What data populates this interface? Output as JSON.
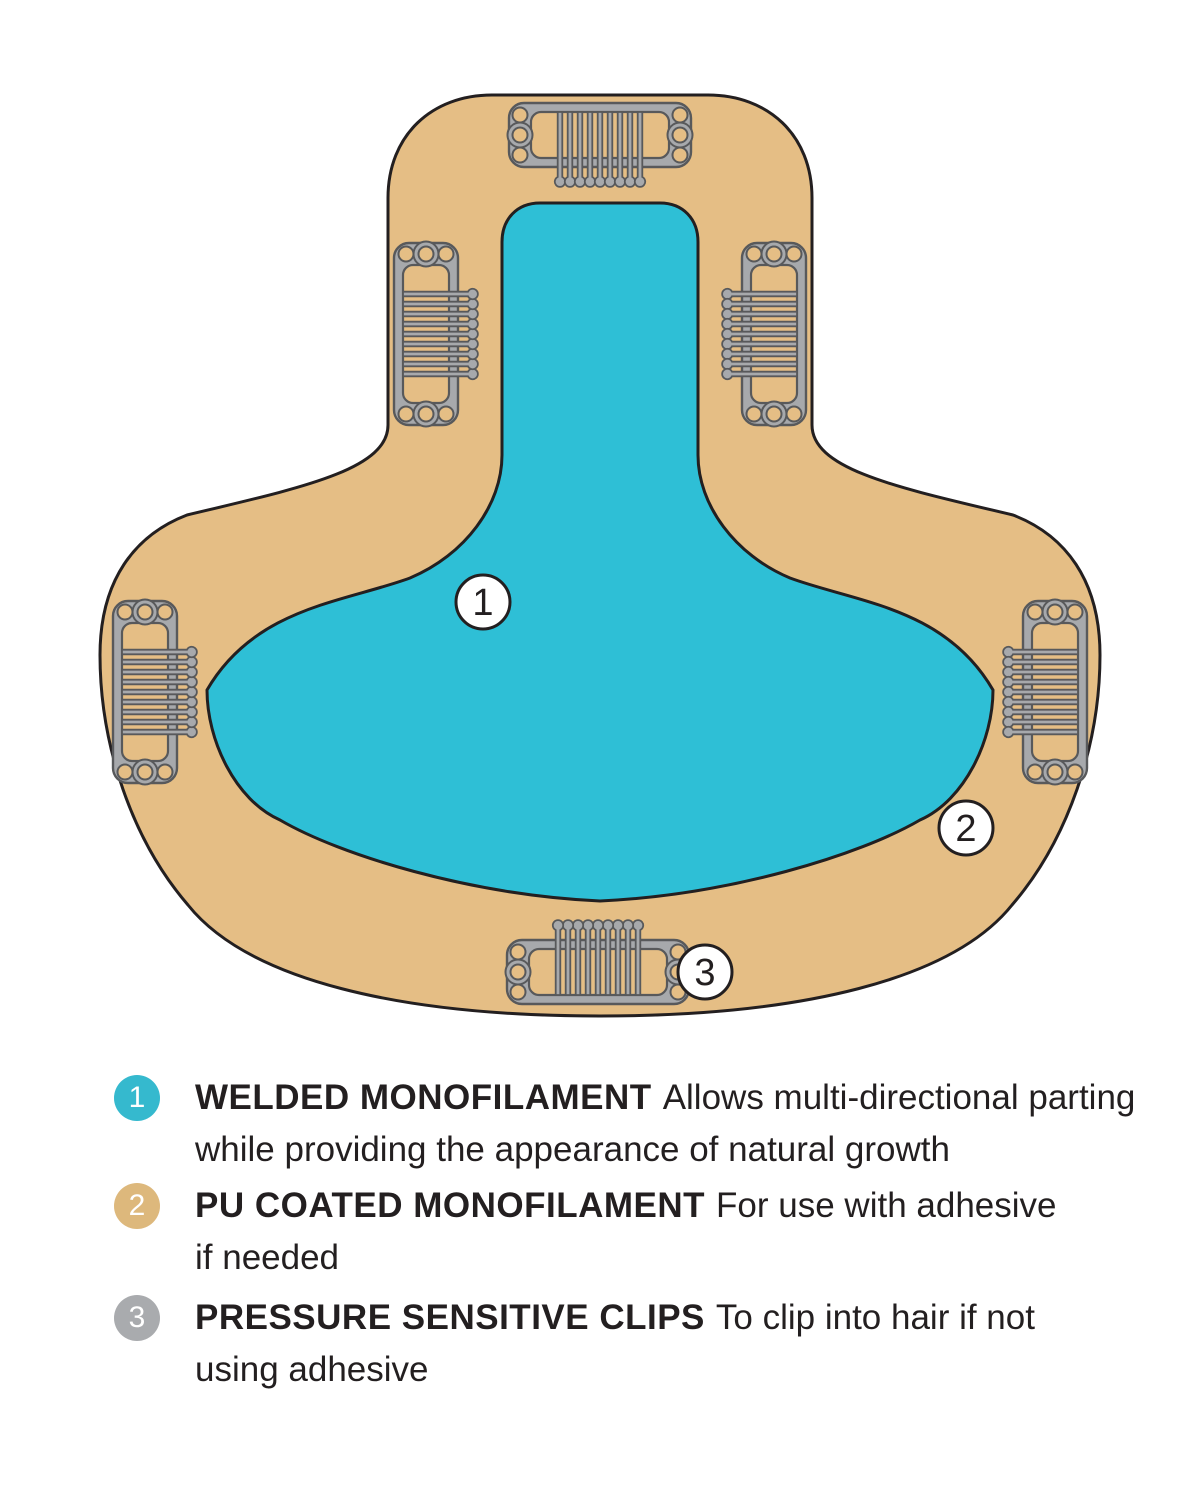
{
  "diagram": {
    "colors": {
      "base": "#E5BE85",
      "mono": "#2EBFD6",
      "clip_body": "#A7A9AC",
      "clip_outline": "#58595B",
      "outline": "#231F20",
      "callout_fill": "#FFFFFF"
    },
    "callouts": [
      {
        "number": "1"
      },
      {
        "number": "2"
      },
      {
        "number": "3"
      }
    ]
  },
  "legend": {
    "items": [
      {
        "number": "1",
        "color": "#35B9CE",
        "term": "WELDED MONOFILAMENT",
        "desc_line1": "Allows multi-directional parting",
        "desc_line2": "while providing the appearance of natural growth"
      },
      {
        "number": "2",
        "color": "#DDB87C",
        "term": "PU COATED MONOFILAMENT",
        "desc_line1": "For use with adhesive",
        "desc_line2": "if needed"
      },
      {
        "number": "3",
        "color": "#A9ABAE",
        "term": "PRESSURE SENSITIVE CLIPS",
        "desc_line1": "To clip into hair if not",
        "desc_line2": "using adhesive"
      }
    ]
  }
}
